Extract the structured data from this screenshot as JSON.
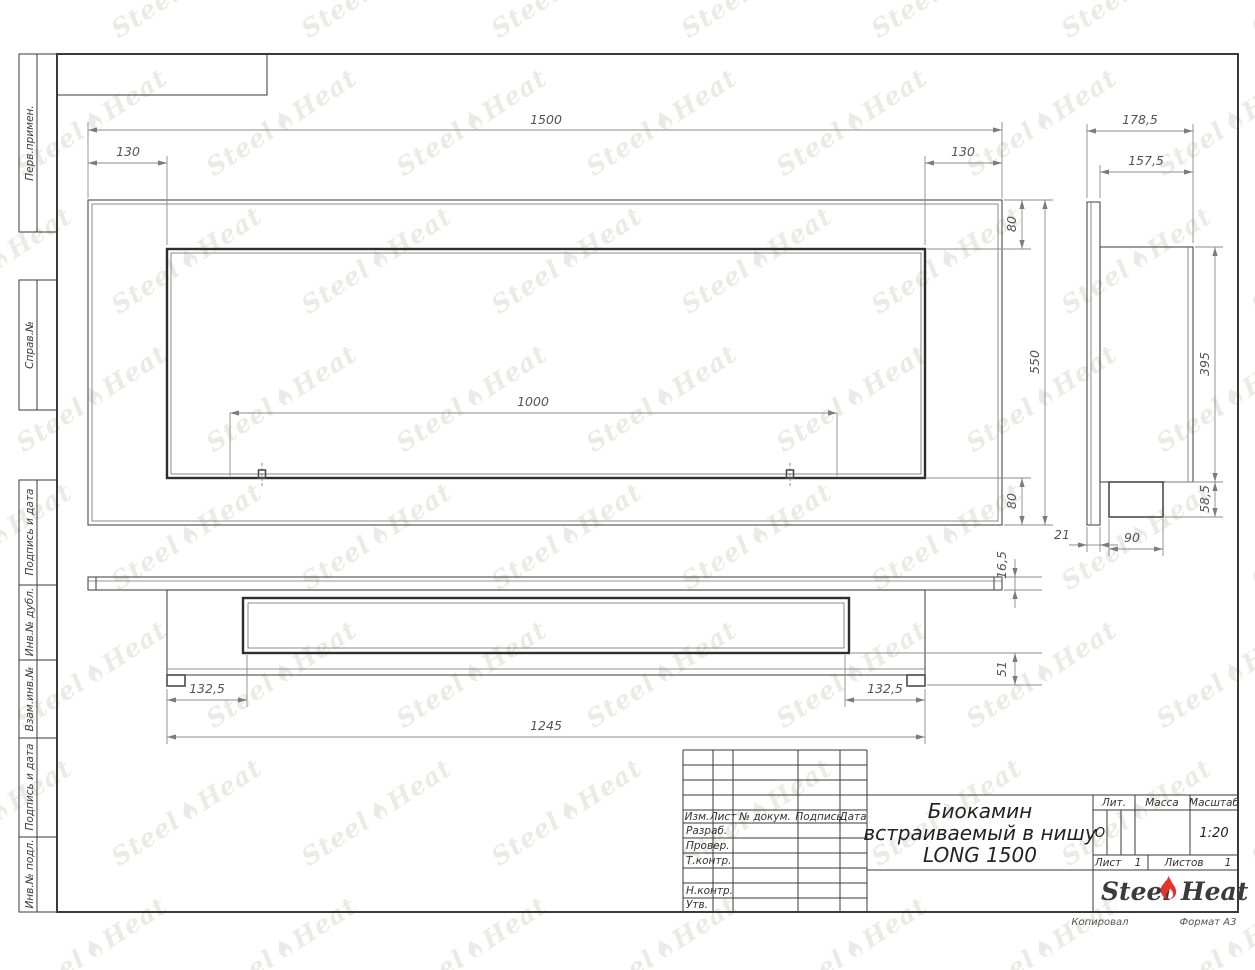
{
  "sheet": {
    "copied_label": "Копировал",
    "format_label": "Формат А3"
  },
  "watermark": {
    "steel": "Steel",
    "heat": "Heat"
  },
  "left_margin_labels": [
    "Перв.примен.",
    "Справ.№",
    "Подпись и дата",
    "Инв.№ дубл.",
    "Взам.инв.№",
    "Подпись и дата",
    "Инв.№ подл."
  ],
  "title_block": {
    "header_cols": {
      "izm": "Изм.",
      "list": "Лист",
      "doc": "№ докум.",
      "sign": "Подпись",
      "date": "Дата"
    },
    "rows": {
      "razrab": "Разраб.",
      "prover": "Провер.",
      "tkontr": "Т.контр.",
      "nkontr": "Н.контр.",
      "utv": "Утв."
    },
    "title_line1": "Биокамин",
    "title_line2": "встраиваемый в нишу",
    "title_line3": "LONG 1500",
    "lit_label": "Лит.",
    "lit_value": "О",
    "massa_label": "Масса",
    "masshtab_label": "Масштаб",
    "masshtab_value": "1:20",
    "list_label": "Лист",
    "list_value": "1",
    "listov_label": "Листов",
    "listov_value": "1",
    "logo": {
      "steel": "Steel",
      "heat": "Heat",
      "flame_color": "#e63329"
    }
  },
  "dims": {
    "front_width": "1500",
    "front_offset_left": "130",
    "front_offset_right": "130",
    "front_top": "80",
    "front_height": "550",
    "front_bottom": "80",
    "mount_spacing": "1000",
    "side_depth_total": "178,5",
    "side_depth_inner": "157,5",
    "side_opening_height": "395",
    "side_box_height": "58,5",
    "side_box_depth": "90",
    "side_flange_thickness": "21",
    "plan_flange_thickness": "16,5",
    "plan_box_height": "51",
    "plan_offset_left": "132,5",
    "plan_offset_right": "132,5",
    "plan_body_width": "1245"
  }
}
